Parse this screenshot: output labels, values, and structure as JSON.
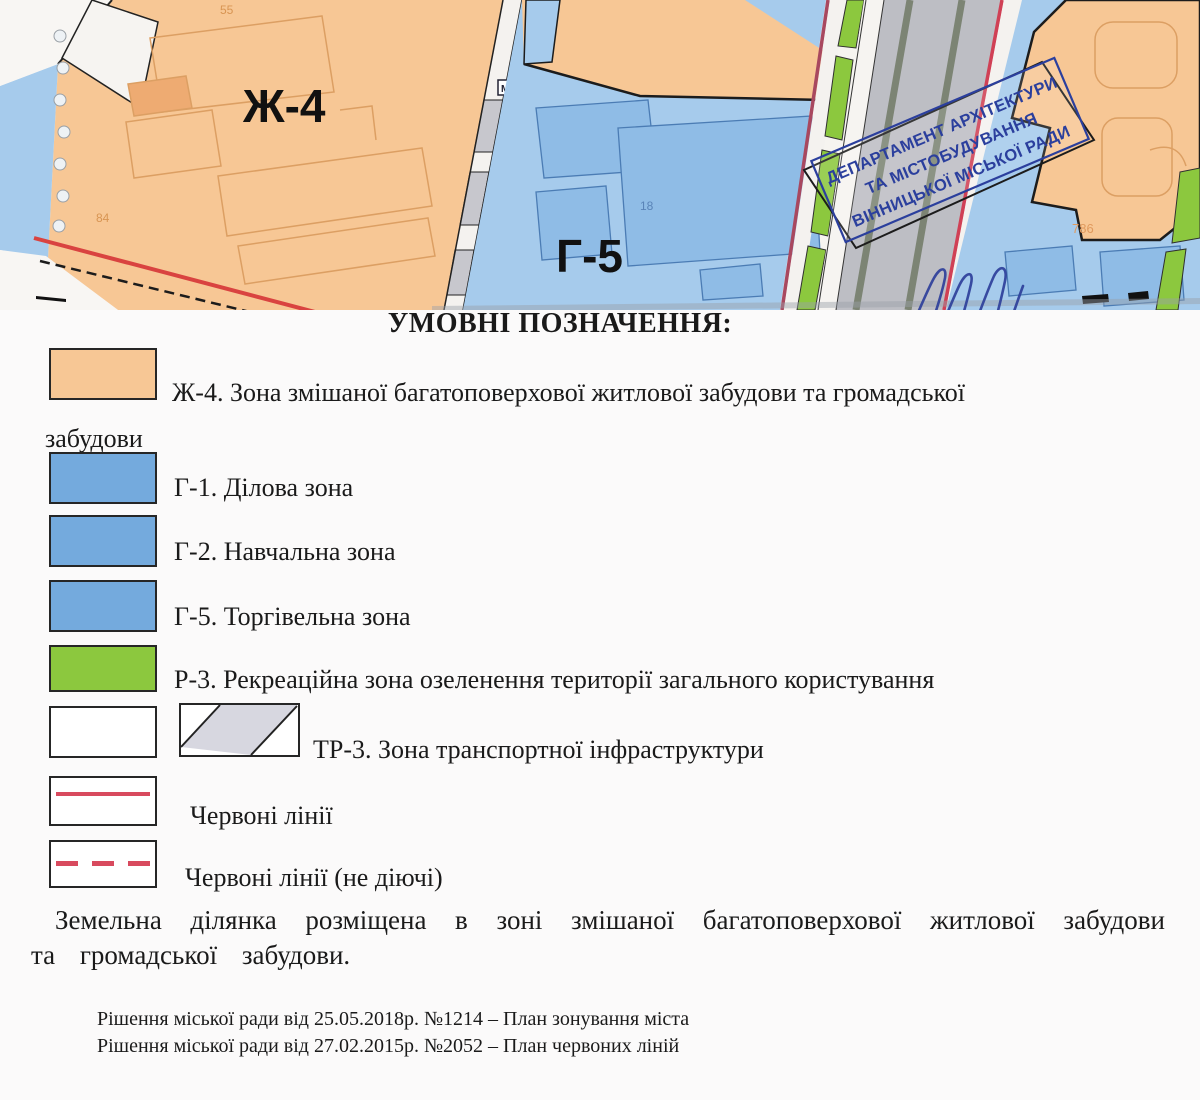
{
  "map": {
    "zone_labels": {
      "zh4": "Ж-4",
      "g5": "Г-5"
    },
    "small_labels": {
      "m": "М",
      "n84": "84",
      "n55": "55",
      "n18": "18",
      "n786": "786"
    },
    "stamp": {
      "line1": "ДЕПАРТАМЕНТ АРХІТЕКТУРИ",
      "line2": "ТА МІСТОБУДУВАННЯ",
      "line3": "ВІННИЦЬКОЇ МІСЬКОЇ РАДИ",
      "color": "#2b3f9d"
    },
    "colors": {
      "residential_orange": "#f7c795",
      "public_blue": "#a6cbec",
      "recreation_green": "#8cc83e",
      "road_gray": "#bdbec4",
      "red_line_bright": "#d94340",
      "red_line_crimson": "#a8485f"
    }
  },
  "legend": {
    "title": "УМОВНІ ПОЗНАЧЕННЯ:",
    "colors": {
      "orange": "#f7c795",
      "blue": "#74aadd",
      "green": "#8cc83e",
      "red_line": "#d84a5e"
    },
    "items": [
      {
        "swatch": "orange",
        "label": "Ж-4. Зона змішаної багатоповерхової житлової забудови та громадської забудови"
      },
      {
        "swatch": "blue",
        "label": "Г-1. Ділова зона"
      },
      {
        "swatch": "blue",
        "label": "Г-2. Навчальна зона"
      },
      {
        "swatch": "blue",
        "label": "Г-5. Торгівельна зона"
      },
      {
        "swatch": "green",
        "label": "Р-3. Рекреаційна зона озеленення території загального користування"
      },
      {
        "swatch": "hatched",
        "label": "ТР-3. Зона транспортної інфраструктури"
      },
      {
        "swatch": "red-solid",
        "label": "Червоні лінії"
      },
      {
        "swatch": "red-dashed",
        "label": "Червоні лінії (не діючі)"
      }
    ]
  },
  "note": "Земельна ділянка розміщена в зоні змішаної багатоповерхової житлової забудови та громадської забудови.",
  "footnotes": [
    "Рішення міської ради від 25.05.2018р. №1214 – План зонування міста",
    "Рішення міської ради від 27.02.2015р. №2052 – План червоних ліній"
  ]
}
